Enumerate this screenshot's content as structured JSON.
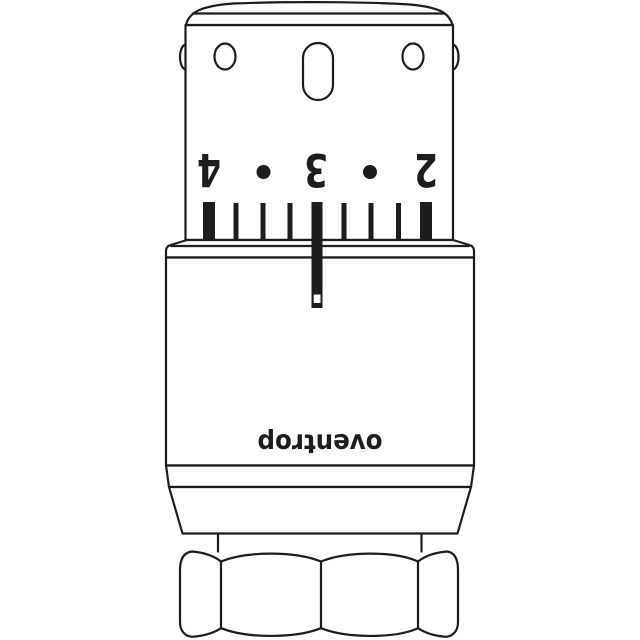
{
  "drawing": {
    "brand_label": "oventrop",
    "scale": {
      "labels": [
        "4",
        "3",
        "2"
      ],
      "dot_separators": 2,
      "tick_marks": 9,
      "pointer_value": "3"
    },
    "orientation": "upside-down",
    "colors": {
      "line": "#1d1d1b",
      "fill": "#ffffff",
      "scale_print": "#1d1d1b"
    }
  }
}
